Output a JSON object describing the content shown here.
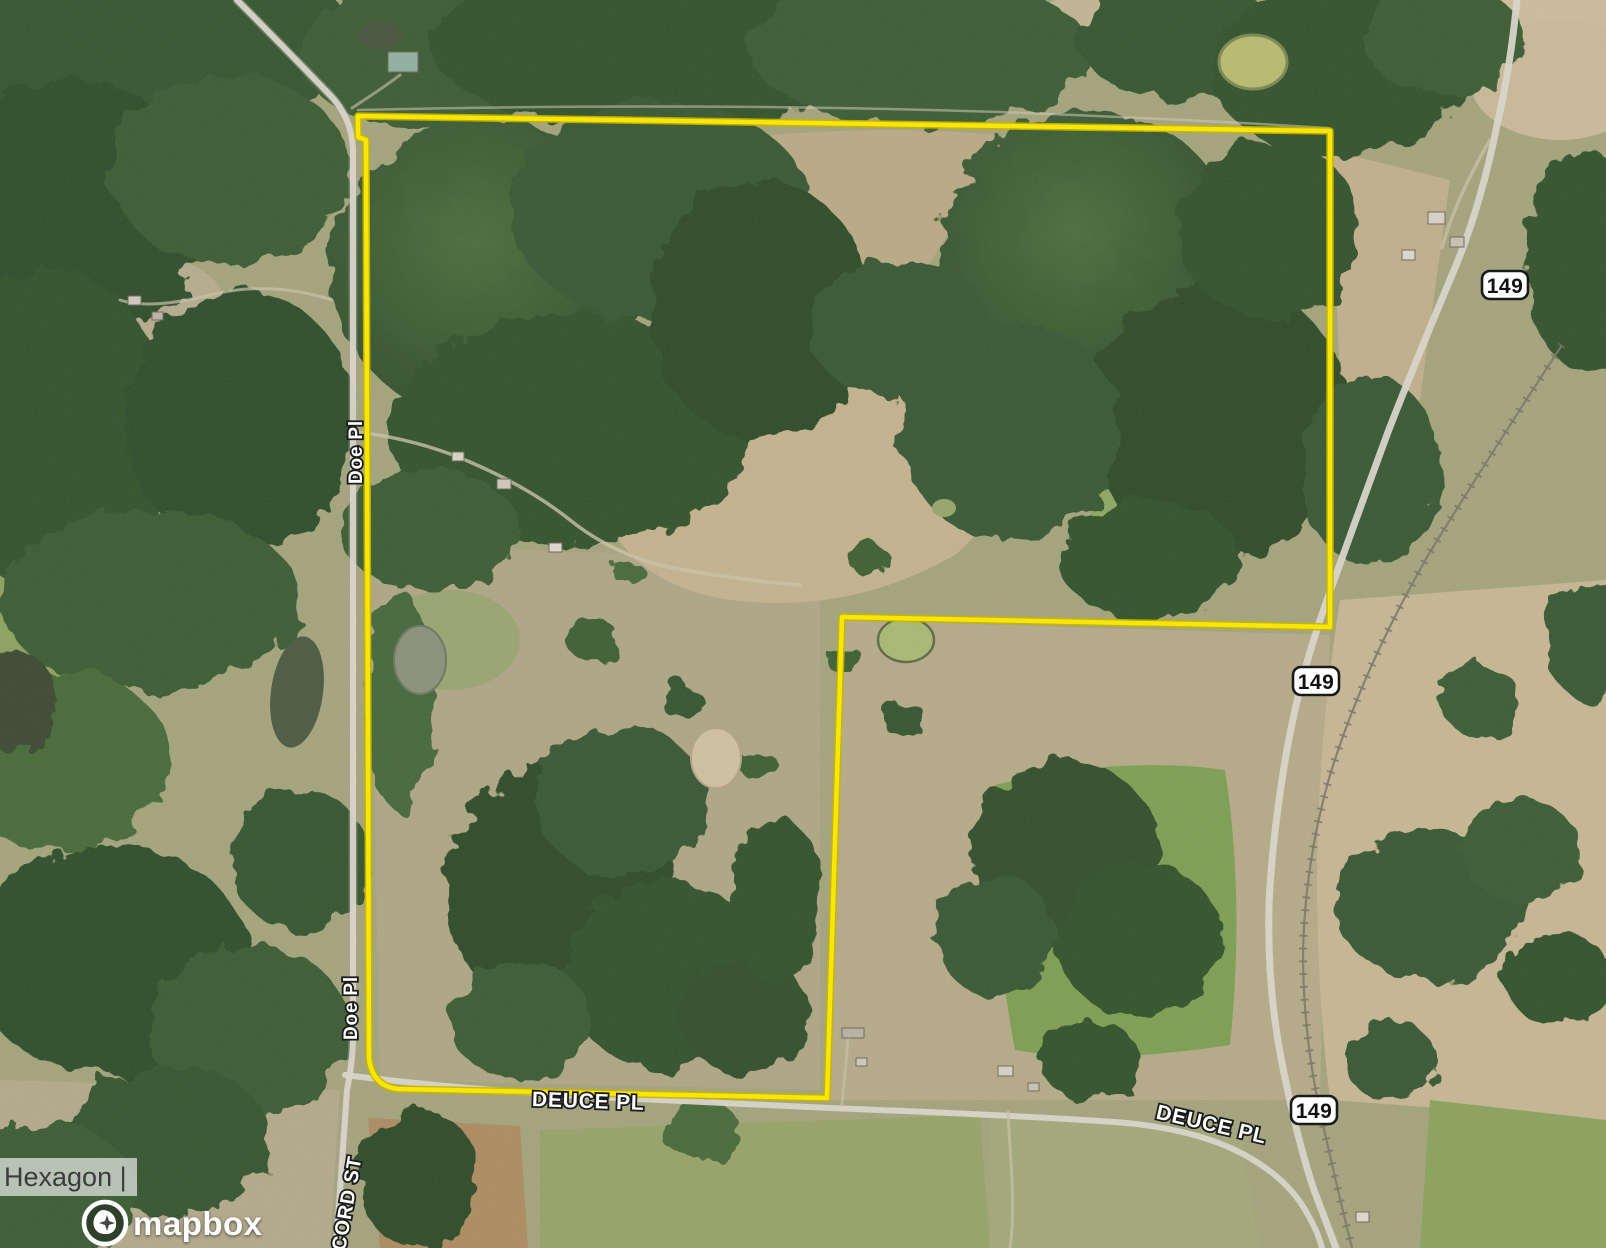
{
  "map": {
    "view": "satellite",
    "attribution": {
      "text": "Hexagon |"
    },
    "logo": {
      "wordmark": "mapbox"
    },
    "road_labels": [
      {
        "id": "doe-pl-north",
        "text": "Doe Pl",
        "orientation": "vertical"
      },
      {
        "id": "doe-pl-south",
        "text": "Doe Pl",
        "orientation": "vertical"
      },
      {
        "id": "deuce-pl-west",
        "text": "DEUCE PL",
        "orientation": "horizontal"
      },
      {
        "id": "deuce-pl-east",
        "text": "DEUCE PL",
        "orientation": "angled"
      },
      {
        "id": "concord-st",
        "text": "NCORD ST",
        "orientation": "vertical"
      }
    ],
    "highway_shields": [
      {
        "id": "route-149-north",
        "text": "149"
      },
      {
        "id": "route-149-mid",
        "text": "149"
      },
      {
        "id": "route-149-south",
        "text": "149"
      }
    ],
    "parcel_boundary": {
      "color": "#f8e706",
      "casing_color": "#c9b400"
    },
    "palette": {
      "forest_dark": "#2e4c27",
      "forest_mid": "#3a5c31",
      "field_tan": "#c4b28e",
      "field_green": "#7d9e52",
      "road": "#d9d6ca",
      "shield_fill": "#ffffff",
      "shield_border": "#1a1a1a"
    }
  }
}
